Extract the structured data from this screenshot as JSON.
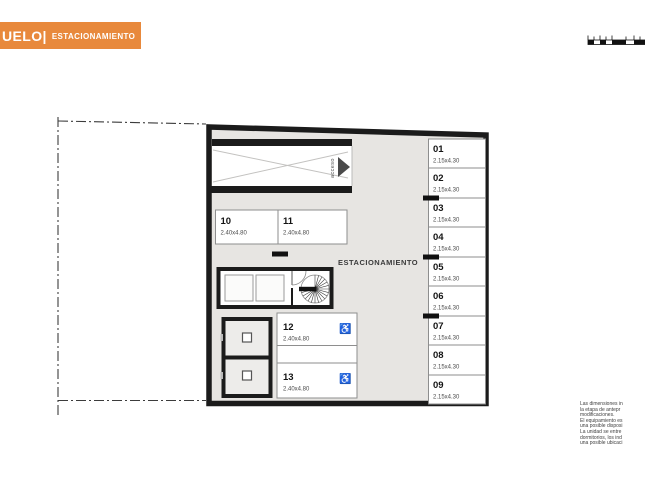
{
  "header": {
    "level_fragment": "UELO|",
    "section_label": "ESTACIONAMIENTO"
  },
  "plan": {
    "area_label": "ESTACIONAMIENTO",
    "ramp_label": "acceso",
    "wheelchair_symbol": "♿",
    "right_spots": [
      {
        "number": "01",
        "dims": "2.15x4.30"
      },
      {
        "number": "02",
        "dims": "2.15x4.30"
      },
      {
        "number": "03",
        "dims": "2.15x4.30"
      },
      {
        "number": "04",
        "dims": "2.15x4.30"
      },
      {
        "number": "05",
        "dims": "2.15x4.30"
      },
      {
        "number": "06",
        "dims": "2.15x4.30"
      },
      {
        "number": "07",
        "dims": "2.15x4.30"
      },
      {
        "number": "08",
        "dims": "2.15x4.30"
      },
      {
        "number": "09",
        "dims": "2.15x4.30"
      }
    ],
    "mid_spots": [
      {
        "number": "10",
        "dims": "2.40x4.80"
      },
      {
        "number": "11",
        "dims": "2.40x4.80"
      }
    ],
    "accessible_spots": [
      {
        "number": "12",
        "dims": "2.40x4.80"
      },
      {
        "number": "13",
        "dims": "2.40x4.80"
      }
    ]
  },
  "disclaimer": {
    "lines": [
      "Las dimensiones in",
      "la etapa de antepr",
      "modificaciones.",
      "El equipamiento es",
      "una posible disposi",
      "La unidad se entre",
      "dormitorios, los ind",
      "una posible ubicaci"
    ]
  },
  "colors": {
    "accent_orange": "#E8893C",
    "floor_gray": "#E7E5E2",
    "wall_black": "#1B1B1B"
  }
}
